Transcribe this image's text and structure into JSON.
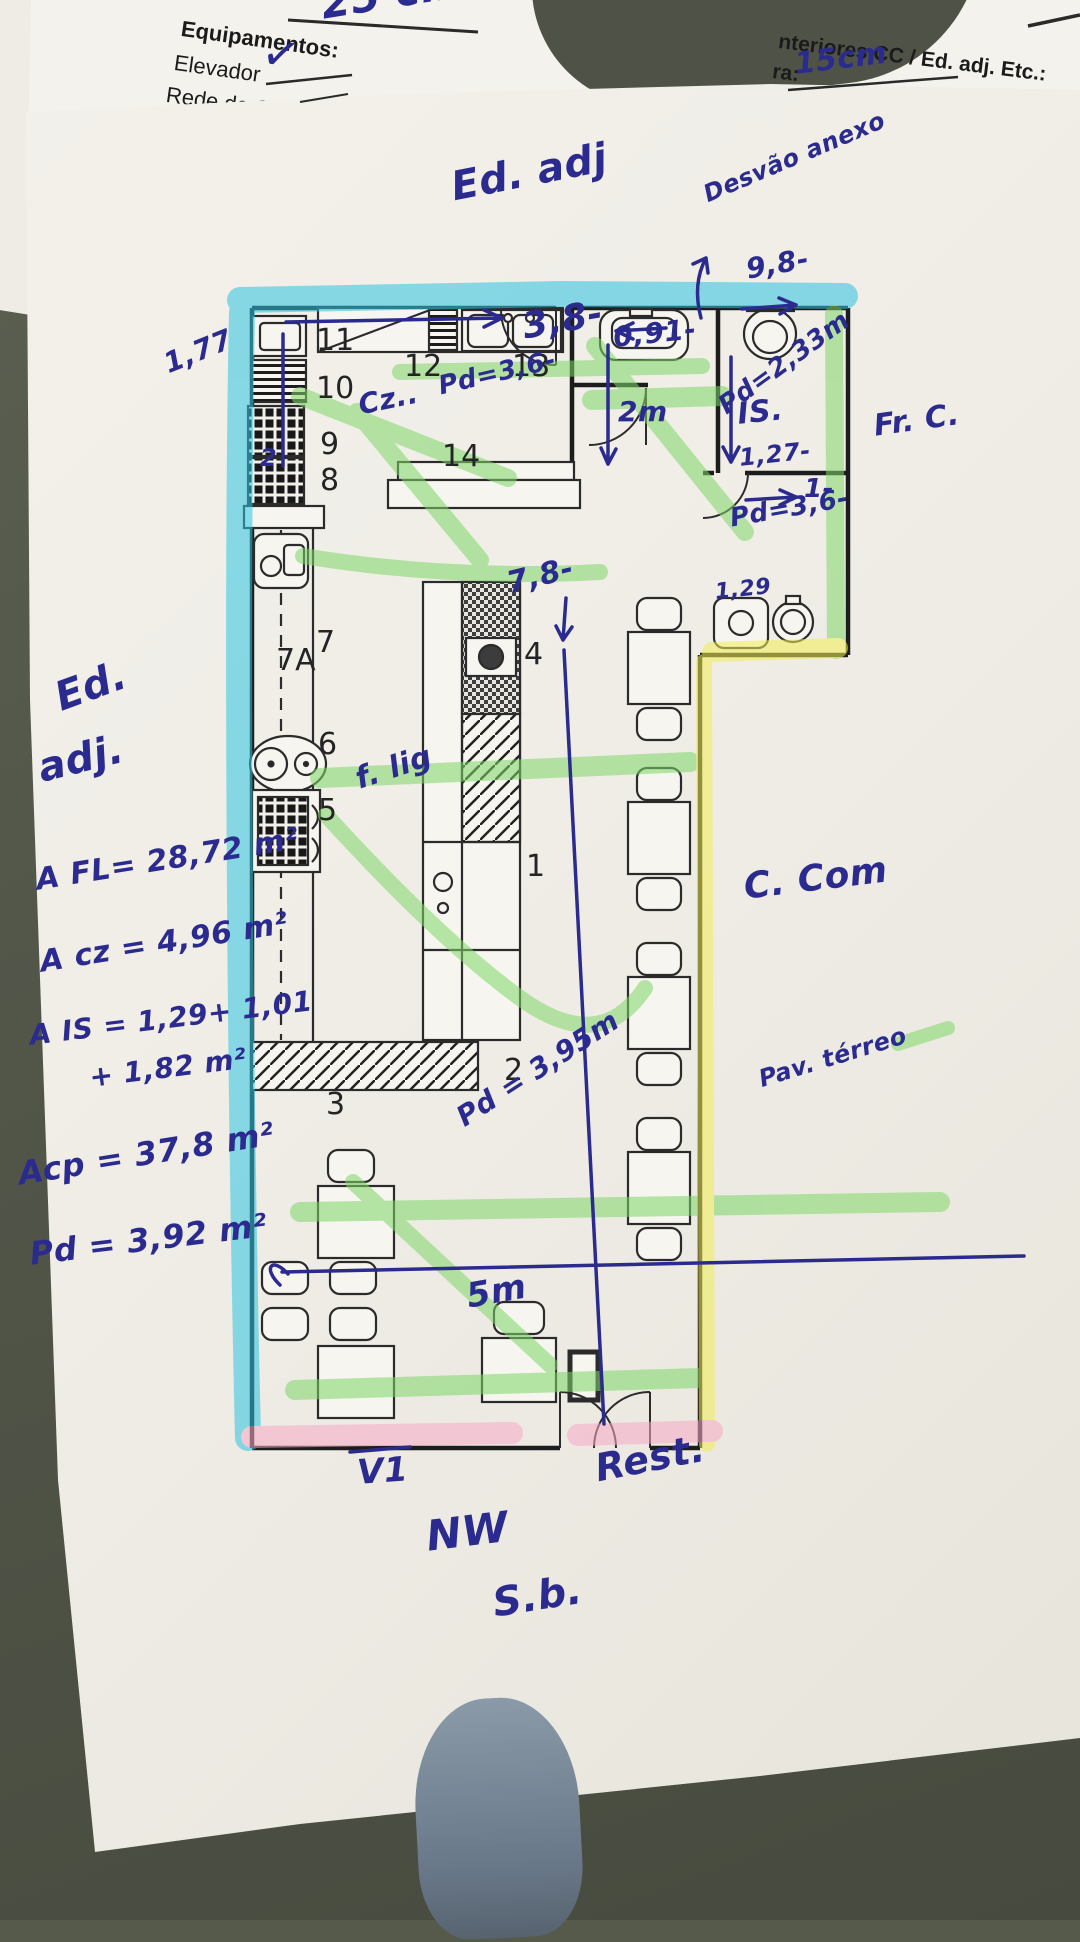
{
  "surface": {
    "table_color": "#565a4b",
    "paper_color": "#efede6",
    "object_color": "#8a9aa8"
  },
  "form_header": {
    "measure_top": "25 cm",
    "equipamentos_label": "Equipamentos:",
    "elevador_label": "Elevador",
    "checkmark": "✓",
    "rede_label": "Rede de C",
    "interiores_label": "nteriores CC / Ed. adj. Etc.:",
    "ra_label": "ra:",
    "ra_value": "15cm"
  },
  "plan": {
    "ink_color": "#2b2b8f",
    "highlighter_colors": {
      "cyan": "#2ec4e2",
      "green": "#7fd768",
      "yellow": "#f2ee55",
      "pink": "#f7aac6"
    },
    "room_labels": [
      {
        "t": "11",
        "x": 316,
        "y": 326
      },
      {
        "t": "12",
        "x": 404,
        "y": 352
      },
      {
        "t": "13",
        "x": 512,
        "y": 352
      },
      {
        "t": "10",
        "x": 316,
        "y": 374
      },
      {
        "t": "9",
        "x": 320,
        "y": 430
      },
      {
        "t": "8",
        "x": 320,
        "y": 466
      },
      {
        "t": "14",
        "x": 442,
        "y": 442
      },
      {
        "t": "7",
        "x": 316,
        "y": 628
      },
      {
        "t": "7A",
        "x": 276,
        "y": 646
      },
      {
        "t": "6",
        "x": 318,
        "y": 730
      },
      {
        "t": "5",
        "x": 318,
        "y": 796
      },
      {
        "t": "4",
        "x": 524,
        "y": 640
      },
      {
        "t": "1",
        "x": 526,
        "y": 852
      },
      {
        "t": "2",
        "x": 504,
        "y": 1056
      },
      {
        "t": "3",
        "x": 326,
        "y": 1090
      }
    ],
    "annotations": [
      {
        "t": "25 cm",
        "x": 318,
        "y": -16,
        "s": 42,
        "r": -9
      },
      {
        "t": "15cm",
        "x": 793,
        "y": 50,
        "s": 30,
        "r": -7
      },
      {
        "t": "✓",
        "x": 266,
        "y": 28,
        "s": 46,
        "r": 10
      },
      {
        "t": "Ed. adj",
        "x": 448,
        "y": 168,
        "s": 40,
        "r": -11
      },
      {
        "t": "Desvão anexo",
        "x": 700,
        "y": 184,
        "s": 24,
        "r": -23
      },
      {
        "t": "9,8-",
        "x": 744,
        "y": 256,
        "s": 28,
        "r": -10
      },
      {
        "t": "1,77",
        "x": 160,
        "y": 352,
        "s": 28,
        "r": -22
      },
      {
        "t": "3,8-",
        "x": 520,
        "y": 310,
        "s": 36,
        "r": -10
      },
      {
        "t": "0,91-",
        "x": 612,
        "y": 324,
        "s": 28,
        "r": -6
      },
      {
        "t": "Pd=2,33m",
        "x": 714,
        "y": 398,
        "s": 26,
        "r": -36
      },
      {
        "t": "IS.",
        "x": 736,
        "y": 400,
        "s": 30,
        "r": -6
      },
      {
        "t": "1,27-",
        "x": 738,
        "y": 446,
        "s": 24,
        "r": -6
      },
      {
        "t": "2m",
        "x": 618,
        "y": 398,
        "s": 28,
        "r": 0
      },
      {
        "t": "1-",
        "x": 804,
        "y": 476,
        "s": 26,
        "r": 0
      },
      {
        "t": "Pd=3,6-",
        "x": 728,
        "y": 506,
        "s": 26,
        "r": -10
      },
      {
        "t": "1,29",
        "x": 714,
        "y": 582,
        "s": 22,
        "r": -6
      },
      {
        "t": "Cz..",
        "x": 356,
        "y": 392,
        "s": 28,
        "r": -12
      },
      {
        "t": "Pd=3,6-",
        "x": 436,
        "y": 374,
        "s": 26,
        "r": -13
      },
      {
        "t": "7,8-",
        "x": 504,
        "y": 570,
        "s": 30,
        "r": -14
      },
      {
        "t": "2",
        "x": 260,
        "y": 446,
        "s": 24,
        "r": 0
      },
      {
        "t": "f. lig",
        "x": 352,
        "y": 766,
        "s": 30,
        "r": -18
      },
      {
        "t": "Ed.",
        "x": 50,
        "y": 680,
        "s": 40,
        "r": -20
      },
      {
        "t": "adj.",
        "x": 34,
        "y": 750,
        "s": 40,
        "r": -14
      },
      {
        "t": "A FL= 28,72 m²",
        "x": 34,
        "y": 866,
        "s": 30,
        "r": -9
      },
      {
        "t": "A cz = 4,96 m²",
        "x": 38,
        "y": 948,
        "s": 30,
        "r": -9
      },
      {
        "t": "A IS = 1,29+ 1,01",
        "x": 28,
        "y": 1022,
        "s": 28,
        "r": -7
      },
      {
        "t": "+ 1,82 m²",
        "x": 88,
        "y": 1064,
        "s": 28,
        "r": -7
      },
      {
        "t": "Acp =  37,8 m²",
        "x": 16,
        "y": 1158,
        "s": 32,
        "r": -9
      },
      {
        "t": "Pd = 3,92 m²",
        "x": 28,
        "y": 1238,
        "s": 32,
        "r": -7
      },
      {
        "t": "Fr. C.",
        "x": 872,
        "y": 412,
        "s": 30,
        "r": -8
      },
      {
        "t": "C. Com",
        "x": 742,
        "y": 870,
        "s": 36,
        "r": -7
      },
      {
        "t": "Pav. térreo",
        "x": 756,
        "y": 1068,
        "s": 24,
        "r": -17
      },
      {
        "t": "Pd = 3,95m",
        "x": 452,
        "y": 1108,
        "s": 28,
        "r": -33
      },
      {
        "t": "5m",
        "x": 464,
        "y": 1280,
        "s": 34,
        "r": -10
      },
      {
        "t": "V1",
        "x": 356,
        "y": 1456,
        "s": 34,
        "r": -4
      },
      {
        "t": "Rest.",
        "x": 592,
        "y": 1450,
        "s": 38,
        "r": -11
      },
      {
        "t": "NW",
        "x": 424,
        "y": 1516,
        "s": 42,
        "r": -7
      },
      {
        "t": "S.b.",
        "x": 490,
        "y": 1584,
        "s": 40,
        "r": -9
      }
    ]
  }
}
